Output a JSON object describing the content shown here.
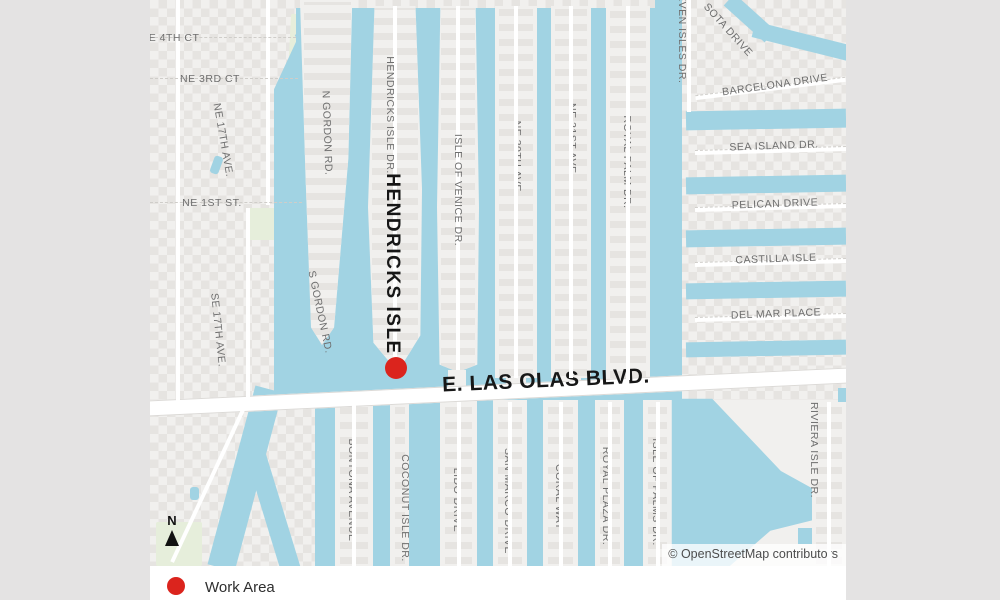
{
  "page": {
    "background_color": "#e4e3e3",
    "card_color": "#ffffff"
  },
  "map": {
    "colors": {
      "water": "#a1d3e3",
      "land": "#f1f0ee",
      "buildings": "#e6e4e1",
      "road": "#ffffff",
      "park": "#e6eedb",
      "street_label": "#6e6e6e",
      "major_label": "#171717",
      "marker_red": "#db241d"
    },
    "major_labels": {
      "isle": "HENDRICKS ISLE",
      "boulevard": "E. LAS OLAS BLVD."
    },
    "street_labels": [
      {
        "id": "ne-4th-ct",
        "text": "NE 4TH CT"
      },
      {
        "id": "ne-3rd-ct",
        "text": "NE 3RD CT"
      },
      {
        "id": "ne-17th-ave",
        "text": "NE 17TH AVE."
      },
      {
        "id": "ne-1st-st",
        "text": "NE 1ST ST."
      },
      {
        "id": "se-17th-ave",
        "text": "SE 17TH AVE."
      },
      {
        "id": "n-gordon-rd",
        "text": "N GORDON RD."
      },
      {
        "id": "s-gordon-rd",
        "text": "S GORDON RD."
      },
      {
        "id": "hendricks-isle-dr",
        "text": "HENDRICKS ISLE DR."
      },
      {
        "id": "isle-of-venice-dr",
        "text": "ISLE OF VENICE DR."
      },
      {
        "id": "ne-20th-ave",
        "text": "NE 20TH AVE."
      },
      {
        "id": "ne-21st-ave",
        "text": "NE 21ST AVE."
      },
      {
        "id": "royal-palm-dr",
        "text": "ROYAL PALM DR."
      },
      {
        "id": "seven-isles-dr",
        "text": "SEVEN ISLES DR."
      },
      {
        "id": "sota-drive",
        "text": "SOTA DRIVE"
      },
      {
        "id": "barcelona-drive",
        "text": "BARCELONA DRIVE"
      },
      {
        "id": "sea-island-dr",
        "text": "SEA ISLAND DR."
      },
      {
        "id": "pelican-drive",
        "text": "PELICAN DRIVE"
      },
      {
        "id": "castilla-isle",
        "text": "CASTILLA ISLE"
      },
      {
        "id": "del-mar-place",
        "text": "DEL MAR PLACE"
      },
      {
        "id": "riviera-isle-dr",
        "text": "RIVIERA ISLE DR."
      },
      {
        "id": "bontona-avenue",
        "text": "BONTONA AVENUE"
      },
      {
        "id": "coconut-isle-dr",
        "text": "COCONUT ISLE DR."
      },
      {
        "id": "lido-drive",
        "text": "LIDO DRIVE"
      },
      {
        "id": "san-marco-drive",
        "text": "SAN MARCO DRIVE"
      },
      {
        "id": "coral-way",
        "text": "CORAL WAY"
      },
      {
        "id": "royal-plaza-dr",
        "text": "ROYAL PLAZA DR."
      },
      {
        "id": "isle-of-palms-dr",
        "text": "ISLE OF PALMS DR."
      }
    ],
    "north_indicator": {
      "letter": "N",
      "icon": "north-arrow"
    },
    "attribution": "© OpenStreetMap contributors"
  },
  "legend": {
    "items": [
      {
        "label": "Work Area",
        "marker_color": "#db241d"
      }
    ]
  }
}
